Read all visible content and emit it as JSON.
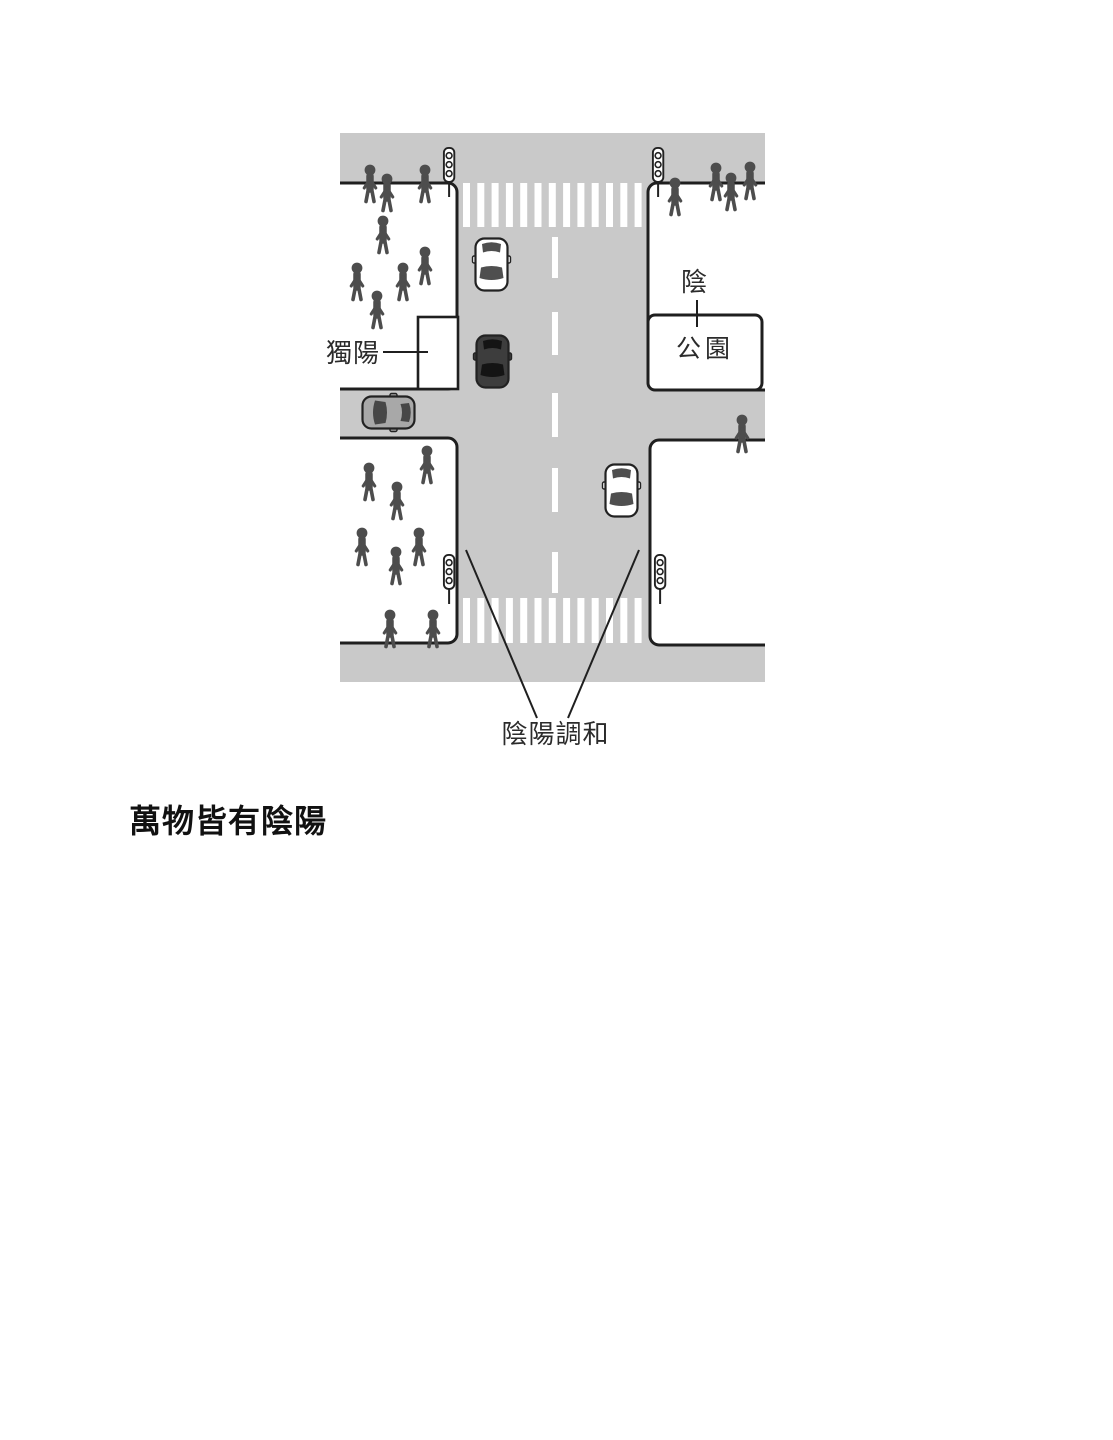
{
  "heading": {
    "text": "萬物皆有陰陽"
  },
  "diagram": {
    "labels": {
      "yin": "陰",
      "park": "公園",
      "lone_yang": "獨陽",
      "harmony": "陰陽調和"
    },
    "colors": {
      "road": "#c9c9c9",
      "block": "#ffffff",
      "outline": "#1f1f1f",
      "pedestrian": "#4d4d4d"
    },
    "car_colors": {
      "car-white": {
        "body": "#ffffff",
        "win": "#4f4f4f"
      },
      "car-black": {
        "body": "#3d3d3d",
        "win": "#141414"
      },
      "car-gray": {
        "body": "#a8a8a8",
        "win": "#474747"
      }
    },
    "pedestrians": {
      "upper_left": [
        [
          30,
          37
        ],
        [
          47,
          46
        ],
        [
          85,
          37
        ],
        [
          43,
          88
        ],
        [
          17,
          135
        ],
        [
          63,
          135
        ],
        [
          85,
          119
        ],
        [
          37,
          163
        ]
      ],
      "upper_right": [
        [
          335,
          50
        ],
        [
          376,
          35
        ],
        [
          391,
          45
        ],
        [
          410,
          34
        ]
      ],
      "middle_right": [
        [
          402,
          287
        ]
      ],
      "lower_left": [
        [
          29,
          335
        ],
        [
          87,
          318
        ],
        [
          57,
          354
        ],
        [
          22,
          400
        ],
        [
          79,
          400
        ],
        [
          56,
          419
        ],
        [
          50,
          482
        ],
        [
          93,
          482
        ]
      ]
    },
    "traffic_lights": [
      [
        103,
        14
      ],
      [
        312,
        14
      ],
      [
        103,
        421
      ],
      [
        314,
        421
      ]
    ],
    "cars": [
      {
        "kind": "car-white",
        "x": 133,
        "y": 104,
        "rot": 0
      },
      {
        "kind": "car-black",
        "x": 134,
        "y": 201,
        "rot": 0
      },
      {
        "kind": "car-gray",
        "x": 76,
        "y": 261,
        "rot": 90
      },
      {
        "kind": "car-white",
        "x": 263,
        "y": 330,
        "rot": 0
      }
    ],
    "counts": {
      "pedestrians_total": 21,
      "cars": 4,
      "traffic_lights": 4
    }
  }
}
